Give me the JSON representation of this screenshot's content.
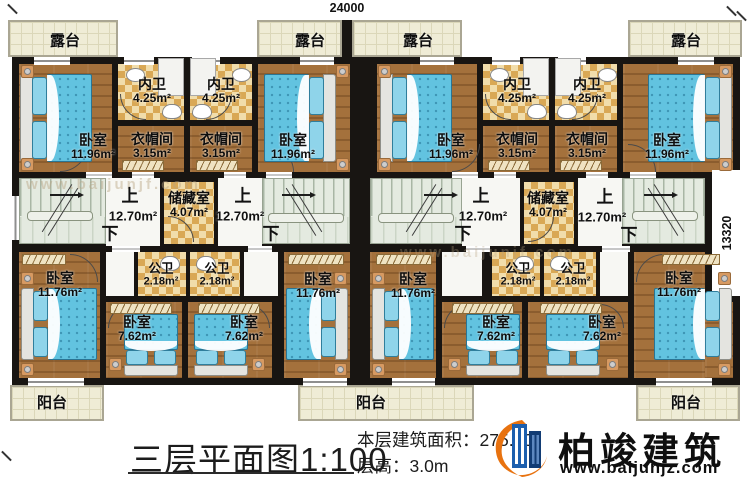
{
  "dimensions": {
    "top_width": "24000",
    "right_height": "13320"
  },
  "rooms": {
    "terrace": "露台",
    "bedroom": "卧室",
    "inner_bath": "内卫",
    "cloakroom": "衣帽间",
    "storage": "储藏室",
    "public_bath": "公卫",
    "balcony": "阳台"
  },
  "areas": {
    "bedroom_top": "11.96m²",
    "inner_bath": "4.25m²",
    "cloakroom": "3.15m²",
    "storage": "4.07m²",
    "hall": "12.70m²",
    "bedroom_bottom": "11.76m²",
    "public_bath": "2.18m²",
    "bedroom_small": "7.62m²"
  },
  "stairs": {
    "up": "上",
    "down": "下"
  },
  "footer": {
    "title": "三层平面图1:100",
    "area_line": "本层建筑面积：275.10",
    "floor_height_line": "层高：3.0m"
  },
  "brand": {
    "name": "柏竣建筑",
    "website": "www.baijunjz.com"
  },
  "watermark": "www.baijunjf.com"
}
